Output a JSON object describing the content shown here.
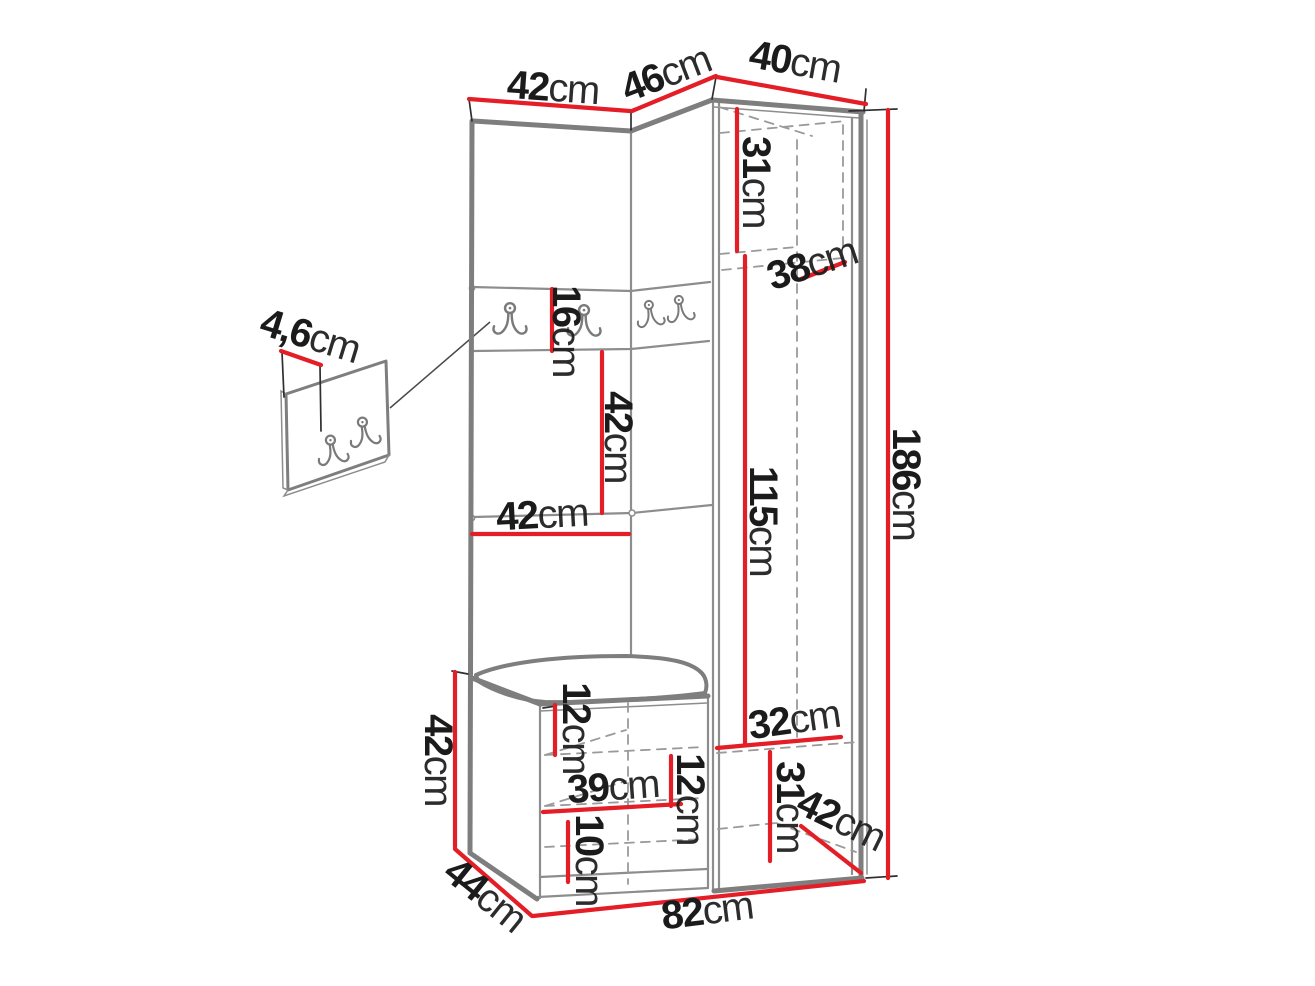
{
  "diagram": {
    "type": "furniture-dimension-drawing",
    "subject": "corner hallway wardrobe set with coat hooks, bench and tall cabinet",
    "background": "#ffffff",
    "colors": {
      "dimension_line": "#e41e26",
      "outline": "#7e7e7e",
      "outline_light": "#8d8d8d",
      "hidden_line": "#9a9a9a",
      "text": "#1b1b1b"
    },
    "dimensions": [
      {
        "id": "top-width-left",
        "value": "42",
        "unit": "cm"
      },
      {
        "id": "top-width-corner",
        "value": "46",
        "unit": "cm"
      },
      {
        "id": "top-width-wardrobe",
        "value": "40",
        "unit": "cm"
      },
      {
        "id": "wardrobe-top-inner-height",
        "value": "31",
        "unit": "cm"
      },
      {
        "id": "wardrobe-depth-top",
        "value": "38",
        "unit": "cm"
      },
      {
        "id": "total-height",
        "value": "186",
        "unit": "cm"
      },
      {
        "id": "hook-panel-depth",
        "value": "4,6",
        "unit": "cm"
      },
      {
        "id": "hook-strip-height",
        "value": "16",
        "unit": "cm"
      },
      {
        "id": "open-section-height",
        "value": "42",
        "unit": "cm"
      },
      {
        "id": "shelf-width",
        "value": "42",
        "unit": "cm"
      },
      {
        "id": "wardrobe-inner-height",
        "value": "115",
        "unit": "cm"
      },
      {
        "id": "bench-under-seat-gap",
        "value": "12",
        "unit": "cm"
      },
      {
        "id": "bench-height",
        "value": "42",
        "unit": "cm"
      },
      {
        "id": "bench-inner-width",
        "value": "39",
        "unit": "cm"
      },
      {
        "id": "bench-shelf-spacing",
        "value": "12",
        "unit": "cm"
      },
      {
        "id": "bench-bottom-shelf-height",
        "value": "10",
        "unit": "cm"
      },
      {
        "id": "wardrobe-bottom-shelf-width",
        "value": "32",
        "unit": "cm"
      },
      {
        "id": "wardrobe-bottom-height",
        "value": "31",
        "unit": "cm"
      },
      {
        "id": "wardrobe-bottom-depth",
        "value": "42",
        "unit": "cm"
      },
      {
        "id": "bench-depth",
        "value": "44",
        "unit": "cm"
      },
      {
        "id": "total-width",
        "value": "82",
        "unit": "cm"
      }
    ]
  }
}
